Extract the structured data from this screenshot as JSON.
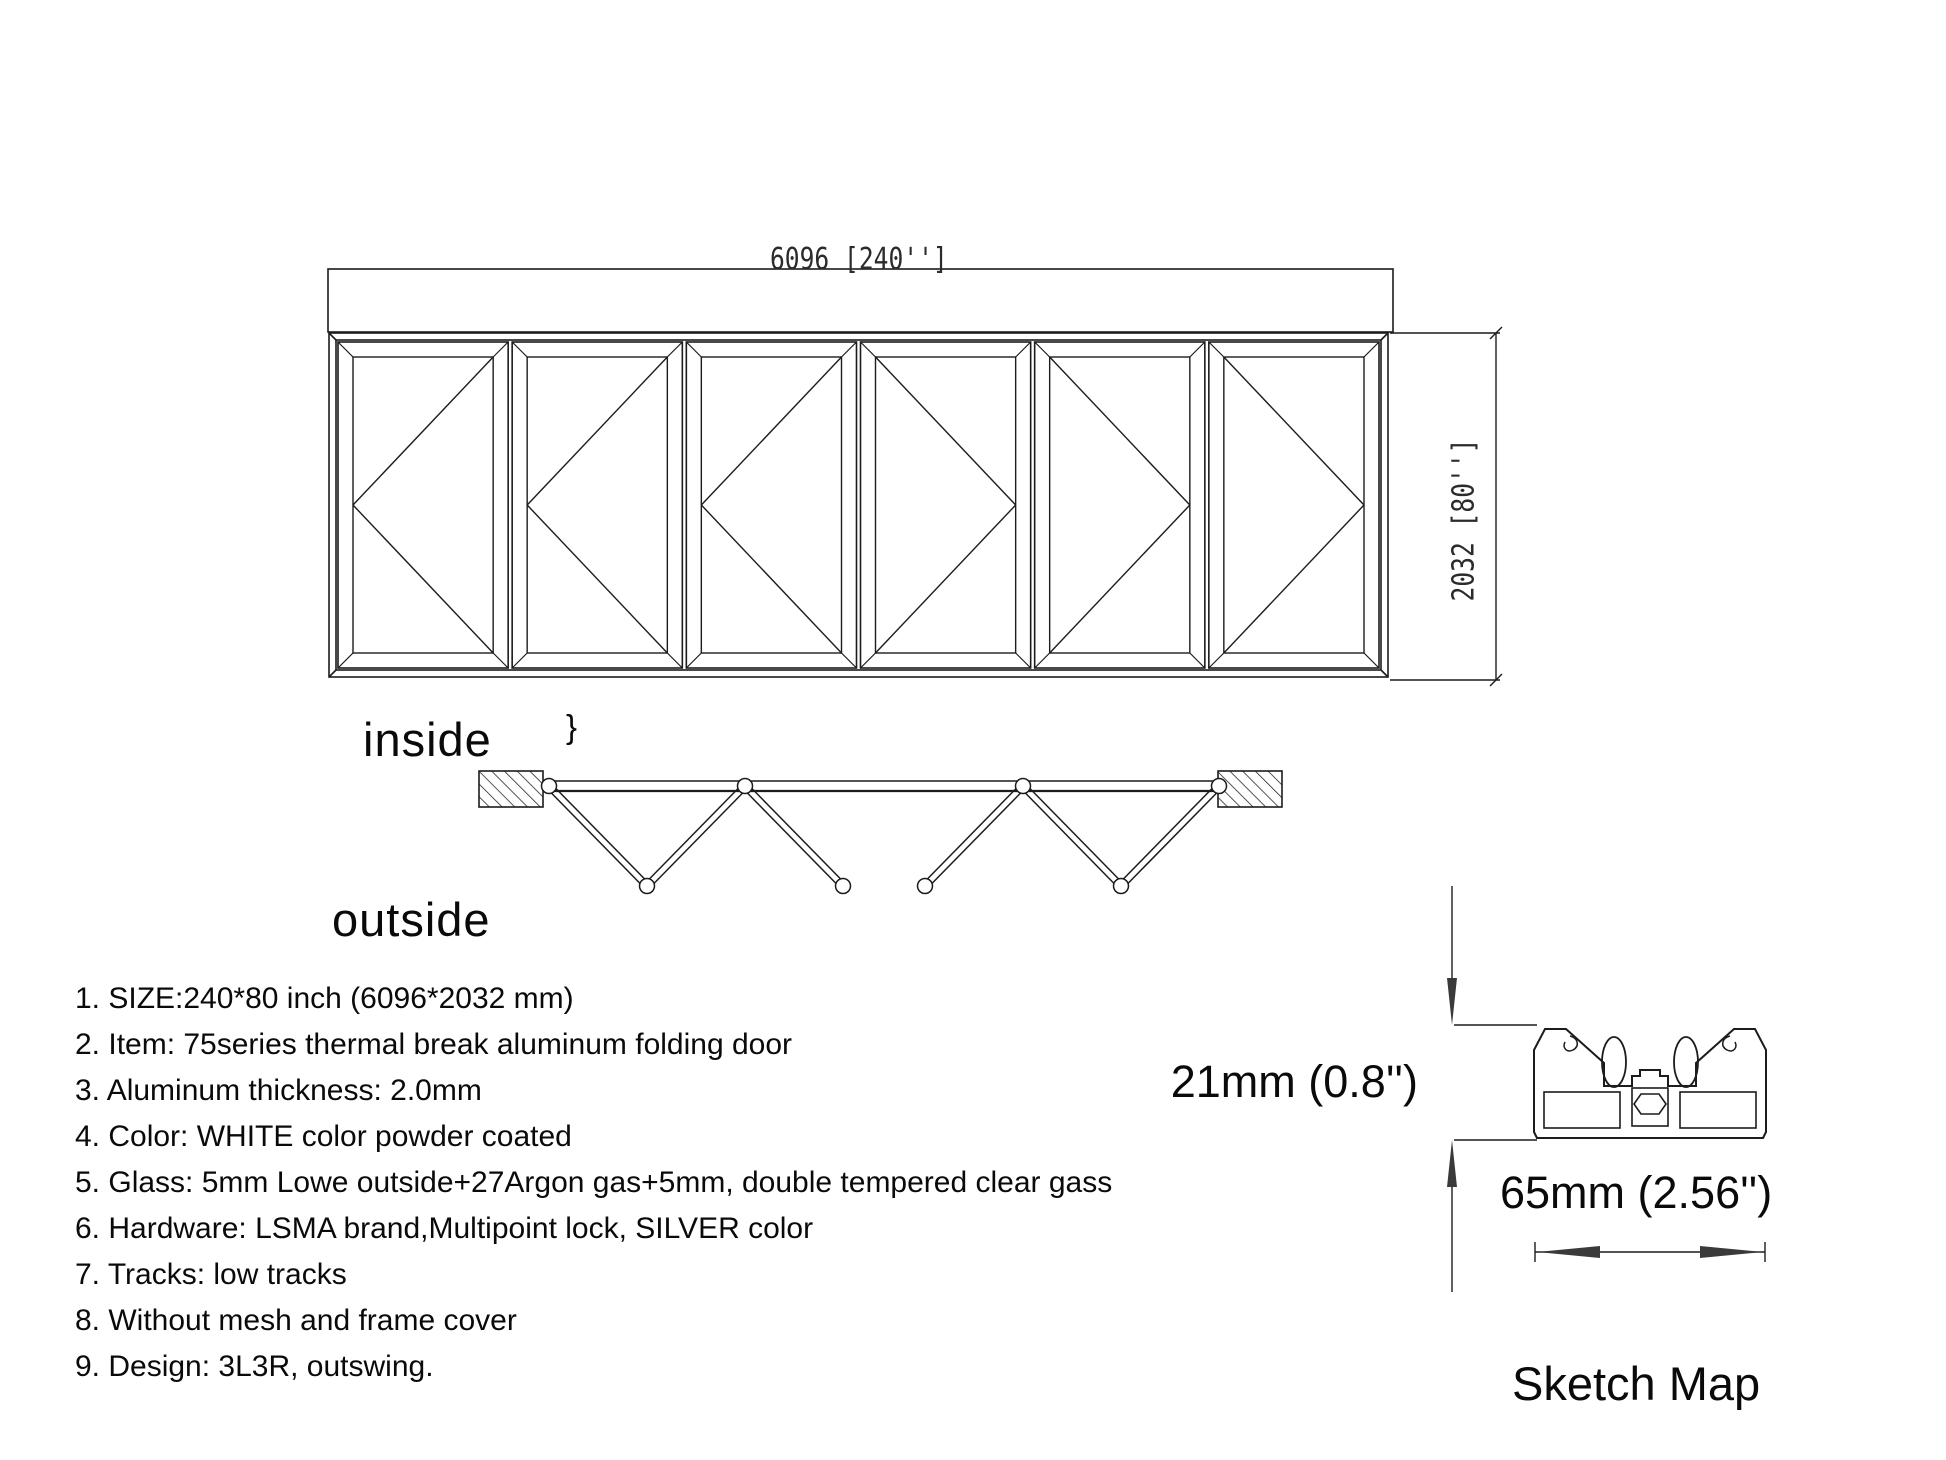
{
  "elevation": {
    "width_label": "6096 [240'']",
    "height_label": "2032 [80'']",
    "panels": [
      "L",
      "L",
      "L",
      "R",
      "R",
      "R"
    ]
  },
  "plan": {
    "inside_label": "inside",
    "outside_label": "outside",
    "mark": "}"
  },
  "sketch": {
    "height_label": "21mm (0.8'')",
    "width_label": "65mm (2.56'')",
    "caption": "Sketch Map"
  },
  "specs": [
    "1. SIZE:240*80 inch (6096*2032 mm)",
    "2. Item: 75series thermal break aluminum folding door",
    "3. Aluminum thickness: 2.0mm",
    "4. Color: WHITE color powder coated",
    "5. Glass: 5mm Lowe outside+27Argon gas+5mm, double tempered clear gass",
    "6. Hardware: LSMA brand,Multipoint lock, SILVER color",
    "7. Tracks: low tracks",
    "8. Without mesh and frame cover",
    "9. Design: 3L3R, outswing."
  ],
  "colors": {
    "line": "#1c1c1c",
    "text": "#0a0a0a",
    "background": "#ffffff"
  }
}
